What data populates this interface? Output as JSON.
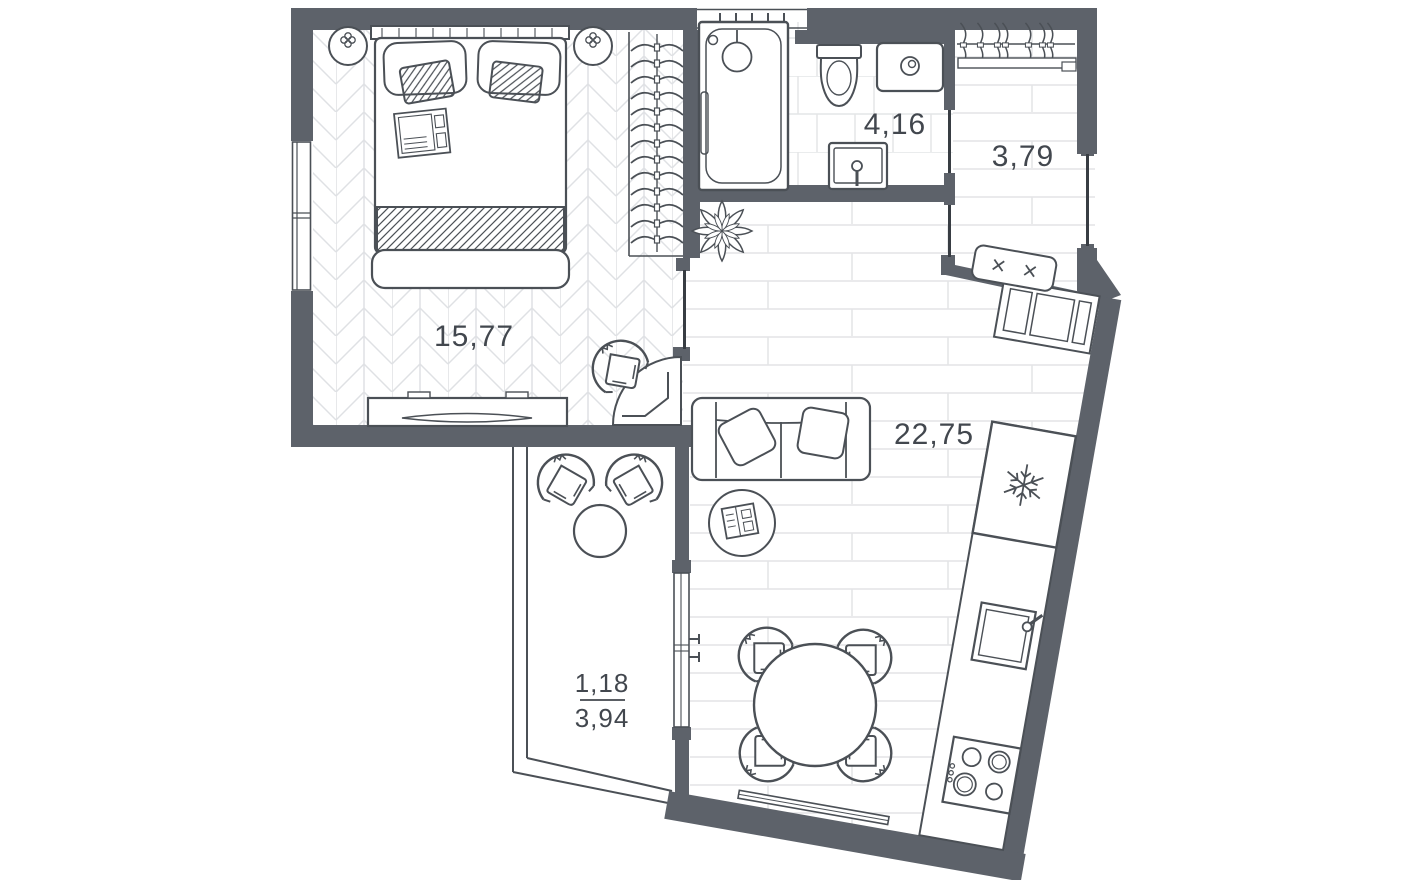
{
  "floorplan": {
    "title": "apartment-floor-plan",
    "rooms": {
      "bedroom": {
        "name": "bedroom",
        "area": "15,77"
      },
      "bathroom": {
        "name": "bathroom",
        "area": "4,16"
      },
      "hallway": {
        "name": "hallway",
        "area": "3,79"
      },
      "living_kitchen": {
        "name": "living-kitchen",
        "area": "22,75"
      },
      "balcony": {
        "name": "balcony",
        "area_reduced": "1,18",
        "area_full": "3,94"
      }
    },
    "colors": {
      "wall": "#5d626a",
      "furniture_line": "#4b5056",
      "door_line": "#383d43",
      "floor_line": "#e3e4e6",
      "label_text": "#42474e"
    },
    "furniture_icons": [
      "double-bed",
      "wall-lamp",
      "wardrobe-hangers",
      "tv-dresser",
      "armchair",
      "bathtub",
      "shower-head",
      "toilet",
      "washing-machine",
      "sink",
      "coat-rack",
      "bench",
      "shoe-cabinet",
      "plant",
      "sofa",
      "coffee-table",
      "round-dining-table",
      "dining-chair",
      "fridge-snowflake",
      "kitchen-sink",
      "stove",
      "balcony-chair",
      "balcony-table"
    ]
  }
}
